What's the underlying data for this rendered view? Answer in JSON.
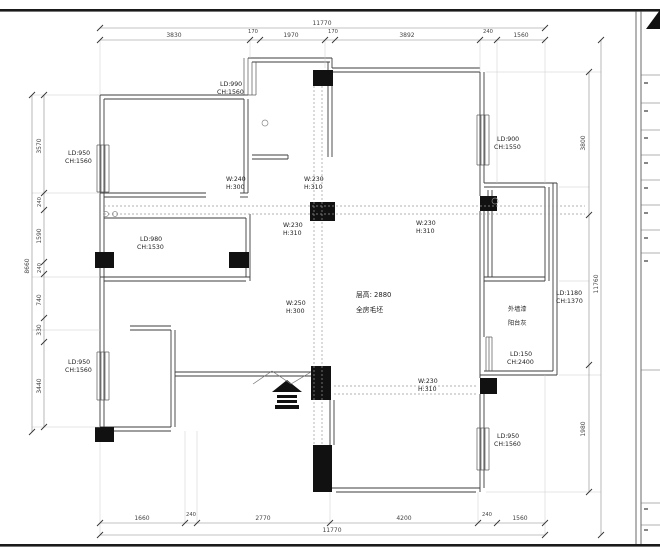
{
  "dimensions": {
    "top_overall": "11770",
    "top_segments": [
      "3830",
      "170",
      "1970",
      "170",
      "3892",
      "240",
      "1560"
    ],
    "bottom_segments": [
      "1660",
      "240",
      "2770",
      "4200",
      "240",
      "1560"
    ],
    "bottom_overall": "11770",
    "left_segments": [
      "3570",
      "240",
      "1590",
      "240",
      "740",
      "330",
      "3440"
    ],
    "left_overall": "8660",
    "right_segments": [
      "3800",
      "1980"
    ],
    "right_overall": "11760"
  },
  "window_labels": [
    {
      "l1": "LD:990",
      "l2": "CH:1560"
    },
    {
      "l1": "LD:950",
      "l2": "CH:1560"
    },
    {
      "l1": "LD:980",
      "l2": "CH:1530"
    },
    {
      "l1": "LD:950",
      "l2": "CH:1560"
    },
    {
      "l1": "LD:900",
      "l2": "CH:1550"
    },
    {
      "l1": "LD:1180",
      "l2": "CH:1370"
    },
    {
      "l1": "LD:150",
      "l2": "CH:2400"
    },
    {
      "l1": "LD:950",
      "l2": "CH:1560"
    }
  ],
  "beam_labels": [
    {
      "l1": "W:240",
      "l2": "H:300"
    },
    {
      "l1": "W:230",
      "l2": "H:310"
    },
    {
      "l1": "W:230",
      "l2": "H:310"
    },
    {
      "l1": "W:230",
      "l2": "H:310"
    },
    {
      "l1": "W:250",
      "l2": "H:300"
    },
    {
      "l1": "W:230",
      "l2": "H:310"
    }
  ],
  "notes": {
    "floor_height": "层高: 2880",
    "finish": "全房毛坯",
    "balcony_wall_1": "外墙漆",
    "balcony_wall_2": "阳台灰"
  }
}
